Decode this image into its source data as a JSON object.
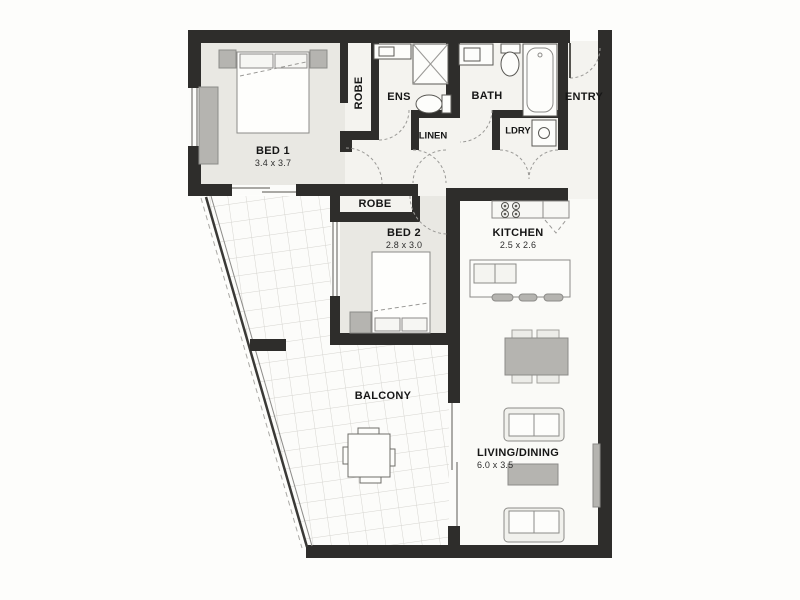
{
  "rooms": {
    "bed1": {
      "label": "BED 1",
      "dims": "3.4 x 3.7"
    },
    "robe1": {
      "label": "ROBE"
    },
    "ens": {
      "label": "ENS"
    },
    "linen": {
      "label": "LINEN"
    },
    "bath": {
      "label": "BATH"
    },
    "ldry": {
      "label": "LDRY"
    },
    "entry": {
      "label": "ENTRY"
    },
    "robe2": {
      "label": "ROBE"
    },
    "bed2": {
      "label": "BED 2",
      "dims": "2.8 x 3.0"
    },
    "kitchen": {
      "label": "KITCHEN",
      "dims": "2.5 x 2.6"
    },
    "balcony": {
      "label": "BALCONY"
    },
    "living": {
      "label": "LIVING/DINING",
      "dims": "6.0 x 3.5"
    }
  },
  "colors": {
    "wall": "#2e2d2b",
    "bedroom_floor": "#e9e8e3",
    "wet_floor": "#f4f3ef",
    "open_floor": "#fafaf7",
    "balcony_floor": "#fcfcfa",
    "grid": "#d6d5d0",
    "furniture": "#b5b4b0",
    "furniture_light": "#ecece8",
    "outline": "#8c8b88",
    "fixture_line": "#5a5955",
    "door_arc": "#9a9996",
    "text": "#161616"
  }
}
